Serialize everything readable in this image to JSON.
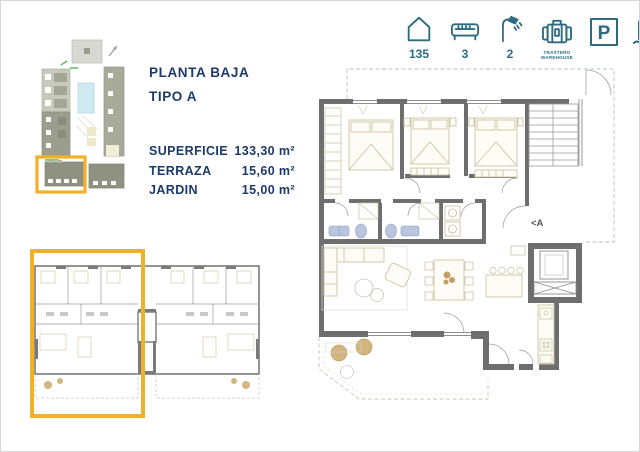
{
  "header": {
    "level": "PLANTA BAJA",
    "type": "TIPO A"
  },
  "specs": [
    {
      "label": "SUPERFICIE",
      "value": "133,30 m²"
    },
    {
      "label": "TERRAZA",
      "value": "15,60 m²"
    },
    {
      "label": "JARDIN",
      "value": "15,00 m²"
    }
  ],
  "amenities": {
    "units": "135",
    "bedrooms": "3",
    "bathrooms": "2",
    "storage_line1": "TRASTERO",
    "storage_line2": "WAREHOUSE",
    "parking_letter": "P"
  },
  "floorplan": {
    "section_marker": "<A"
  },
  "colors": {
    "navy_text": "#1b3a6b",
    "teal_icons": "#2d6b80",
    "highlight_yellow": "#f0b127",
    "wall_gray": "#6e6e6e",
    "furniture_tan": "#cfc3a2",
    "fixture_blue": "#b9c4de",
    "site_building": "#8f9181",
    "pool_blue": "#cfeaf2",
    "accent_green": "#3fae49"
  }
}
